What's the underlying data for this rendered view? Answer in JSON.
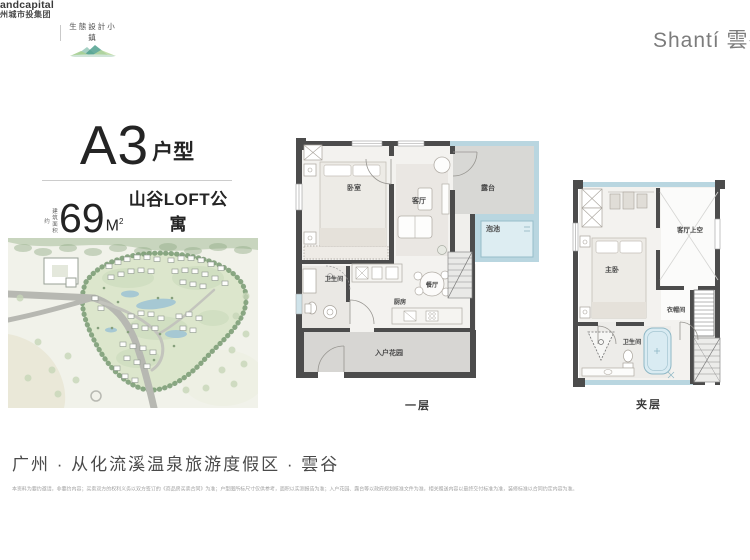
{
  "header": {
    "logo_group_line1": "andcapital",
    "logo_group_line2": "州城市投集团",
    "logo_eco_text": "生態設計小鎮",
    "brand": "Shantí 雲谷"
  },
  "title": {
    "name": "A3",
    "suffix": "户型",
    "area_label": "建筑面积约",
    "area_value": "69",
    "area_unit": "M",
    "area_exp": "2",
    "tagline": "山谷LOFT公寓"
  },
  "plans": {
    "first": {
      "caption": "一层",
      "rooms": {
        "bedroom": "卧室",
        "living": "客厅",
        "terrace": "露台",
        "pool": "泡池",
        "bath": "卫生间",
        "dining": "餐厅",
        "kitchen": "厨房",
        "garden": "入户花园"
      }
    },
    "mezzanine": {
      "caption": "夹层",
      "rooms": {
        "master": "主卧",
        "void": "客厅上空",
        "closet": "衣帽间",
        "bath": "卫生间"
      }
    }
  },
  "footer": {
    "location": "广州 · 从化流溪温泉旅游度假区 · 雲谷",
    "disclaimer": "本资料为要约邀请，非要约内容；买卖双方的权利义务以双方签订的《商品房买卖合同》为准；户型图所标尺寸仅供参考，面积以实测报告为准；入户花园、露台等以政府规划核准文件为准，相关赠送内容以最终交付标准为准，装修标准以合同约定内容为准。"
  },
  "colors": {
    "accent_blue": "#b9d6e0",
    "wall": "#4c4c4c",
    "terrace_gray": "#d8d8d5",
    "map_green": "#dce6cc"
  }
}
